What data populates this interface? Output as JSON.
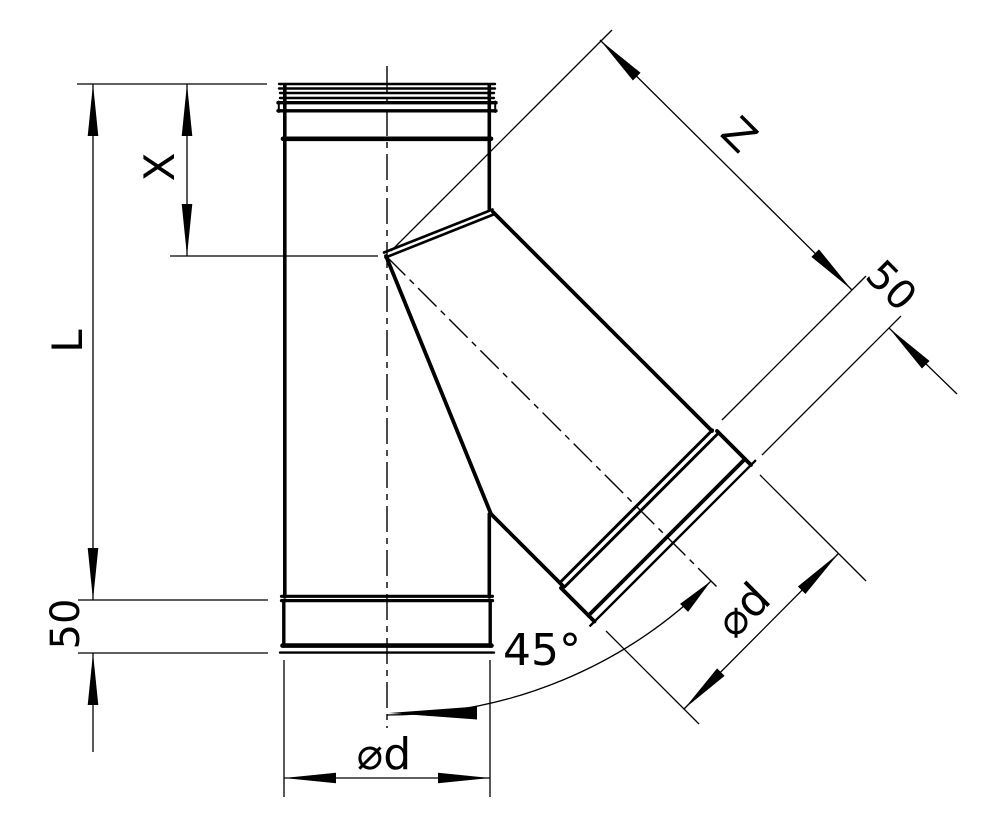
{
  "canvas": {
    "background": "#ffffff",
    "line_color": "#000000"
  },
  "figure": {
    "kind": "technical-drawing",
    "subject": "tee-pipe-fitting-45-degree-branch-side-view"
  },
  "dimensions": {
    "x_inset": {
      "label": "X"
    },
    "overall_length": {
      "label": "L"
    },
    "main_socket_depth": {
      "label": "50"
    },
    "branch_length": {
      "label": "Z"
    },
    "branch_socket_depth": {
      "label": "50"
    },
    "branch_diameter": {
      "label": "⌀d"
    },
    "branch_angle": {
      "label": "45°"
    },
    "main_diameter": {
      "label": "⌀d"
    }
  }
}
